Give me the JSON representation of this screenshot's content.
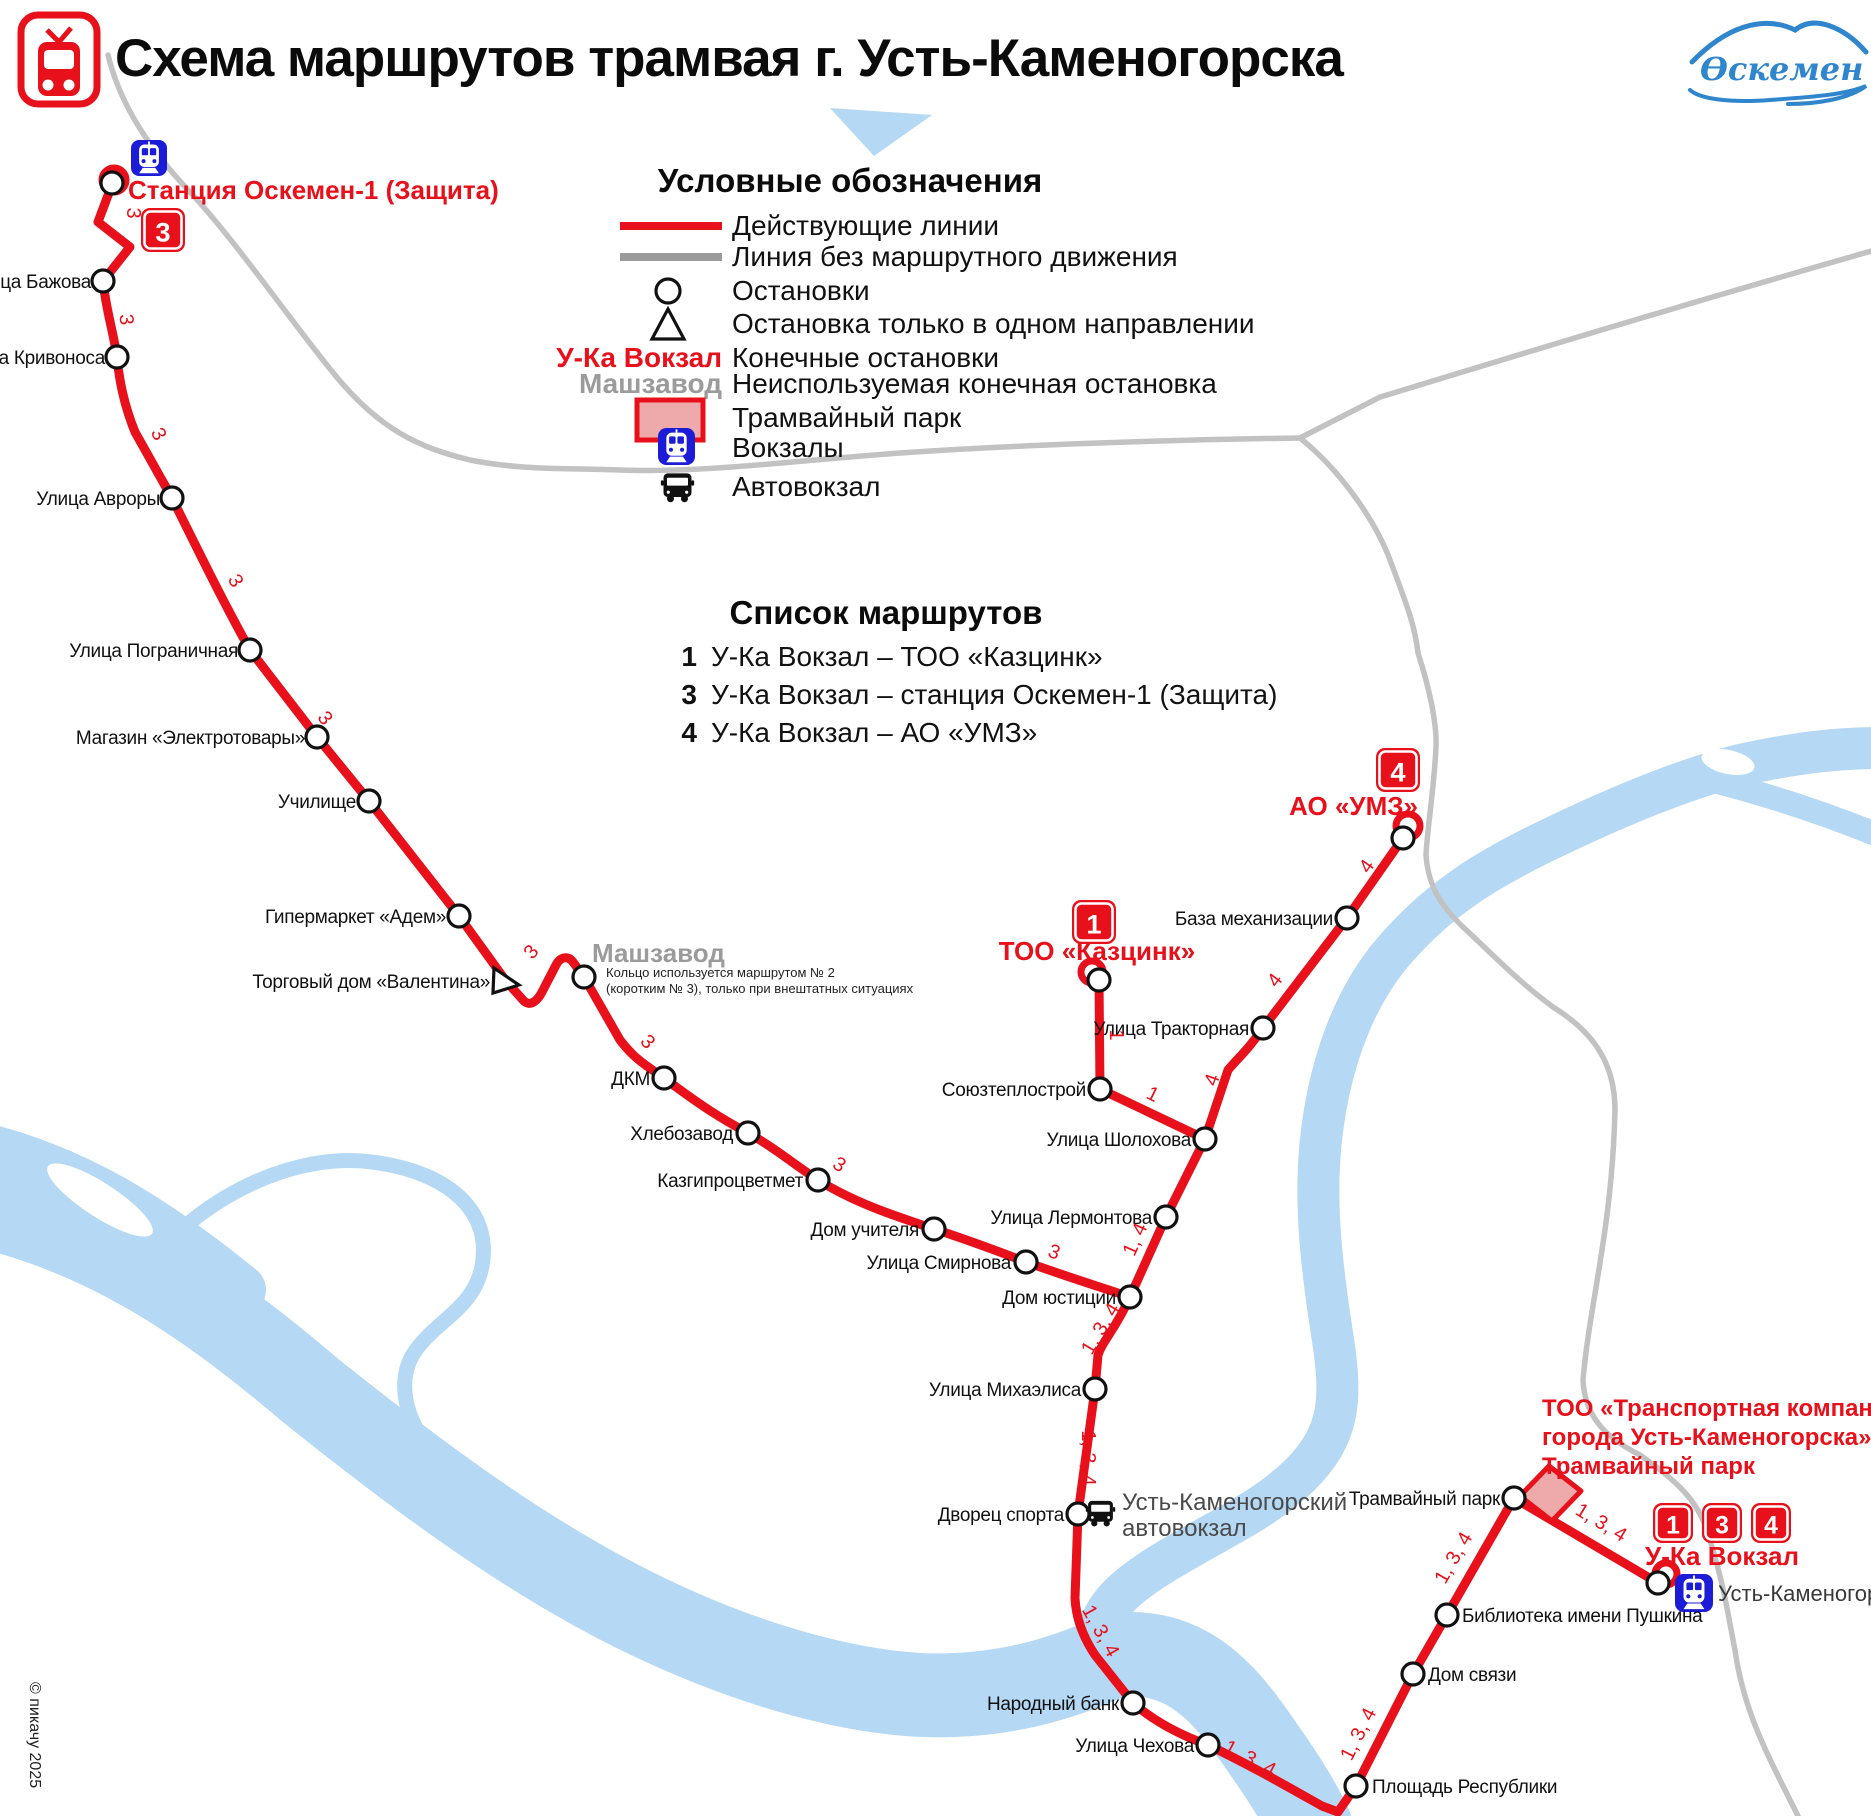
{
  "title": "Схема маршрутов трамвая г. Усть-Каменогорска",
  "logo_text": "Өскемен",
  "copyright": "© пикачу 2025",
  "colors": {
    "red": "#e8101a",
    "rail_gray": "#c2c2c2",
    "river_blue": "#b5d8f4",
    "depot_pink": "#eeaaaa",
    "station_blue": "#1b1bd8"
  },
  "legend": {
    "title": "Условные обозначения",
    "items": [
      {
        "id": "active-line",
        "label": "Действующие линии"
      },
      {
        "id": "unused-line",
        "label": "Линия без маршрутного движения"
      },
      {
        "id": "stop",
        "label": "Остановки"
      },
      {
        "id": "oneway-stop",
        "label": "Остановка только в одном направлении"
      },
      {
        "id": "terminal",
        "symbol_text": "У-Ка Вокзал",
        "label": "Конечные остановки"
      },
      {
        "id": "unused-terminal",
        "symbol_text": "Машзавод",
        "label": "Неиспользуемая конечная остановка"
      },
      {
        "id": "depot",
        "label": "Трамвайный парк"
      },
      {
        "id": "rail-station",
        "label": "Вокзалы"
      },
      {
        "id": "bus-station",
        "label": "Автовокзал"
      }
    ]
  },
  "routes": {
    "title": "Список маршрутов",
    "items": [
      {
        "number": "1",
        "label": "У-Ка Вокзал – ТОО «Казцинк»"
      },
      {
        "number": "3",
        "label": "У-Ка Вокзал – станция Оскемен-1 (Защита)"
      },
      {
        "number": "4",
        "label": "У-Ка Вокзал – АО «УМЗ»"
      }
    ]
  },
  "map": {
    "stops": [
      {
        "name": "Станция Оскемен-1 (Защита)",
        "kind": "terminal",
        "style": "terminal",
        "x": 112,
        "y": 183,
        "lx": 128,
        "ly": 199,
        "anchor": "start"
      },
      {
        "name": "Улица Бажова",
        "kind": "stop",
        "x": 103,
        "y": 281,
        "lx": 91,
        "ly": 288,
        "anchor": "end"
      },
      {
        "name": "Улица Кривоноса",
        "kind": "stop",
        "x": 117,
        "y": 357,
        "lx": 105,
        "ly": 364,
        "anchor": "end"
      },
      {
        "name": "Улица Авроры",
        "kind": "stop",
        "x": 172,
        "y": 498,
        "lx": 160,
        "ly": 505,
        "anchor": "end"
      },
      {
        "name": "Улица Пограничная",
        "kind": "stop",
        "x": 250,
        "y": 650,
        "lx": 238,
        "ly": 657,
        "anchor": "end"
      },
      {
        "name": "Магазин «Электротовары»",
        "kind": "stop",
        "x": 317,
        "y": 737,
        "lx": 305,
        "ly": 744,
        "anchor": "end"
      },
      {
        "name": "Училище",
        "kind": "stop",
        "x": 369,
        "y": 801,
        "lx": 356,
        "ly": 808,
        "anchor": "end"
      },
      {
        "name": "Гипермаркет «Адем»",
        "kind": "stop",
        "x": 459,
        "y": 916,
        "lx": 446,
        "ly": 923,
        "anchor": "end"
      },
      {
        "name": "Торговый дом «Валентина»",
        "kind": "oneway",
        "x": 506,
        "y": 981,
        "lx": 490,
        "ly": 988,
        "anchor": "end"
      },
      {
        "name": "Машзавод",
        "kind": "stop",
        "style": "unused",
        "x": 584,
        "y": 977,
        "lx": 592,
        "ly": 962,
        "anchor": "start"
      },
      {
        "name": "ДКМ",
        "kind": "stop",
        "x": 664,
        "y": 1078,
        "lx": 650,
        "ly": 1085,
        "anchor": "end"
      },
      {
        "name": "Хлебозавод",
        "kind": "stop",
        "x": 748,
        "y": 1133,
        "lx": 733,
        "ly": 1140,
        "anchor": "end"
      },
      {
        "name": "Казгипроцветмет",
        "kind": "stop",
        "x": 818,
        "y": 1180,
        "lx": 803,
        "ly": 1187,
        "anchor": "end"
      },
      {
        "name": "Дом учителя",
        "kind": "stop",
        "x": 934,
        "y": 1229,
        "lx": 919,
        "ly": 1236,
        "anchor": "end"
      },
      {
        "name": "Улица Смирнова",
        "kind": "stop",
        "x": 1026,
        "y": 1262,
        "lx": 1011,
        "ly": 1269,
        "anchor": "end"
      },
      {
        "name": "ТОО «Казцинк»",
        "kind": "terminal",
        "style": "terminal",
        "x": 1099,
        "y": 980,
        "lx": 1097,
        "ly": 960,
        "anchor": "middle"
      },
      {
        "name": "Союзтеплострой",
        "kind": "stop",
        "x": 1100,
        "y": 1089,
        "lx": 1086,
        "ly": 1096,
        "anchor": "end"
      },
      {
        "name": "АО «УМЗ»",
        "kind": "terminal",
        "style": "terminal",
        "x": 1403,
        "y": 838,
        "lx": 1418,
        "ly": 815,
        "anchor": "end"
      },
      {
        "name": "База механизации",
        "kind": "stop",
        "x": 1347,
        "y": 918,
        "lx": 1333,
        "ly": 925,
        "anchor": "end"
      },
      {
        "name": "Улица Тракторная",
        "kind": "stop",
        "x": 1263,
        "y": 1028,
        "lx": 1249,
        "ly": 1035,
        "anchor": "end"
      },
      {
        "name": "Улица Шолохова",
        "kind": "stop",
        "x": 1205,
        "y": 1139,
        "lx": 1191,
        "ly": 1146,
        "anchor": "end"
      },
      {
        "name": "Улица Лермонтова",
        "kind": "stop",
        "x": 1166,
        "y": 1217,
        "lx": 1152,
        "ly": 1224,
        "anchor": "end"
      },
      {
        "name": "Дом юстиции",
        "kind": "stop",
        "x": 1130,
        "y": 1297,
        "lx": 1116,
        "ly": 1304,
        "anchor": "end"
      },
      {
        "name": "Улица Михаэлиса",
        "kind": "stop",
        "x": 1095,
        "y": 1389,
        "lx": 1081,
        "ly": 1396,
        "anchor": "end"
      },
      {
        "name": "Дворец спорта",
        "kind": "stop",
        "x": 1078,
        "y": 1514,
        "lx": 1064,
        "ly": 1521,
        "anchor": "end"
      },
      {
        "name": "Народный банк",
        "kind": "stop",
        "x": 1133,
        "y": 1703,
        "lx": 1119,
        "ly": 1710,
        "anchor": "end"
      },
      {
        "name": "Улица Чехова",
        "kind": "stop",
        "x": 1208,
        "y": 1745,
        "lx": 1194,
        "ly": 1752,
        "anchor": "end"
      },
      {
        "name": "Площадь Республики",
        "kind": "stop",
        "x": 1356,
        "y": 1786,
        "lx": 1372,
        "ly": 1793,
        "anchor": "start"
      },
      {
        "name": "Дом связи",
        "kind": "stop",
        "x": 1413,
        "y": 1674,
        "lx": 1428,
        "ly": 1681,
        "anchor": "start"
      },
      {
        "name": "Библиотека имени Пушкина",
        "kind": "stop",
        "x": 1447,
        "y": 1615,
        "lx": 1462,
        "ly": 1622,
        "anchor": "start"
      },
      {
        "name": "Трамвайный парк",
        "kind": "stop",
        "x": 1514,
        "y": 1498,
        "lx": 1500,
        "ly": 1505,
        "anchor": "end"
      },
      {
        "name": "У-Ка Вокзал",
        "kind": "terminal",
        "style": "terminal",
        "x": 1658,
        "y": 1583,
        "lx": 1722,
        "ly": 1565,
        "anchor": "middle"
      }
    ],
    "line_labels": [
      {
        "t": "3",
        "x": 127,
        "y": 213,
        "r": 90
      },
      {
        "t": "3",
        "x": 120,
        "y": 320,
        "r": 85
      },
      {
        "t": "3",
        "x": 153,
        "y": 437,
        "r": 62
      },
      {
        "t": "3",
        "x": 230,
        "y": 584,
        "r": 60
      },
      {
        "t": "3",
        "x": 320,
        "y": 722,
        "r": 52
      },
      {
        "t": "3",
        "x": 536,
        "y": 956,
        "r": -49
      },
      {
        "t": "3",
        "x": 643,
        "y": 1046,
        "r": 48
      },
      {
        "t": "3",
        "x": 836,
        "y": 1170,
        "r": 32
      },
      {
        "t": "3",
        "x": 1052,
        "y": 1258,
        "r": 20
      },
      {
        "t": "1",
        "x": 1110,
        "y": 1035,
        "r": 90
      },
      {
        "t": "1",
        "x": 1150,
        "y": 1100,
        "r": 26
      },
      {
        "t": "4",
        "x": 1372,
        "y": 870,
        "r": -55
      },
      {
        "t": "4",
        "x": 1280,
        "y": 984,
        "r": -53
      },
      {
        "t": "4",
        "x": 1218,
        "y": 1082,
        "r": -70
      },
      {
        "t": "1, 4",
        "x": 1141,
        "y": 1242,
        "r": -66
      },
      {
        "t": "1, 3, 4",
        "x": 1106,
        "y": 1332,
        "r": -59
      },
      {
        "t": "1, 3, 4",
        "x": 1082,
        "y": 1458,
        "r": 90
      },
      {
        "t": "1, 3, 4",
        "x": 1095,
        "y": 1634,
        "r": 61
      },
      {
        "t": "1, 3, 4",
        "x": 1247,
        "y": 1764,
        "r": 28
      },
      {
        "t": "1, 3, 4",
        "x": 1364,
        "y": 1737,
        "r": -63
      },
      {
        "t": "1, 3, 4",
        "x": 1459,
        "y": 1561,
        "r": -60
      },
      {
        "t": "1, 3, 4",
        "x": 1598,
        "y": 1528,
        "r": 31
      }
    ],
    "badges": [
      {
        "t": "3",
        "x": 141,
        "y": 208,
        "s": 44
      },
      {
        "t": "1",
        "x": 1072,
        "y": 900,
        "s": 44
      },
      {
        "t": "4",
        "x": 1376,
        "y": 748,
        "s": 44
      },
      {
        "t": "1",
        "x": 1653,
        "y": 1503,
        "s": 40
      },
      {
        "t": "3",
        "x": 1702,
        "y": 1503,
        "s": 40
      },
      {
        "t": "4",
        "x": 1751,
        "y": 1503,
        "s": 40
      }
    ],
    "note_line1": "Кольцо используется маршрутом № 2",
    "note_line2": "(коротким № 3), только при внештатных ситуациях",
    "company_label": [
      "ТОО «Транспортная компания",
      "города Усть-Каменогорска»",
      "Трамвайный парк"
    ],
    "bus_station_label": [
      "Усть-Каменогорский",
      "автовокзал"
    ],
    "city_label": "Усть-Каменогорск"
  }
}
